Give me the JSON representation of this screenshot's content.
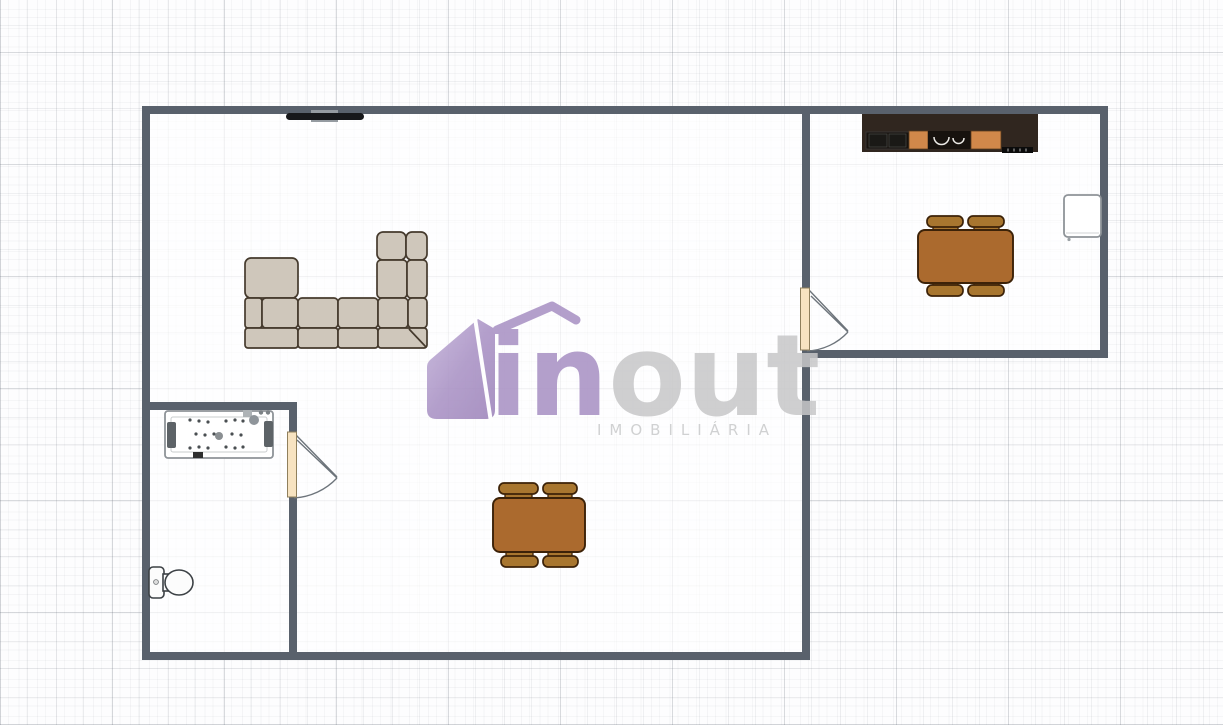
{
  "watermark": {
    "brand_in": "in",
    "brand_out": "out",
    "subtitle": "IMOBILIÁRIA"
  },
  "colors": {
    "wall": "#59616c",
    "door": "#f7e3c1",
    "door-stroke": "#8f7f5c",
    "swing": "#6d747b",
    "sofa": "#cfc7bb",
    "sofa-stroke": "#453a2d",
    "table": "#ab6a2e",
    "table-stroke": "#3c2208",
    "chair": "#a8762f",
    "counter": "#30261f",
    "cabinet": "#d1884a",
    "appliance-dark": "#17120e",
    "fixture-stroke": "#8e9398",
    "fixture-dark": "#5d6367",
    "toilet-stroke": "#3c4145",
    "brand-purple": "#a78fc3",
    "brand-gray": "#c7c7c8",
    "brand-sub": "#c9cacb"
  },
  "objects": [
    "wall-mounted-tv",
    "sectional-sofa",
    "living-dining-table",
    "kitchen-counter",
    "refrigerator",
    "kitchen-dining-table",
    "bathtub",
    "toilet",
    "interior-door-kitchen",
    "interior-door-bathroom"
  ]
}
